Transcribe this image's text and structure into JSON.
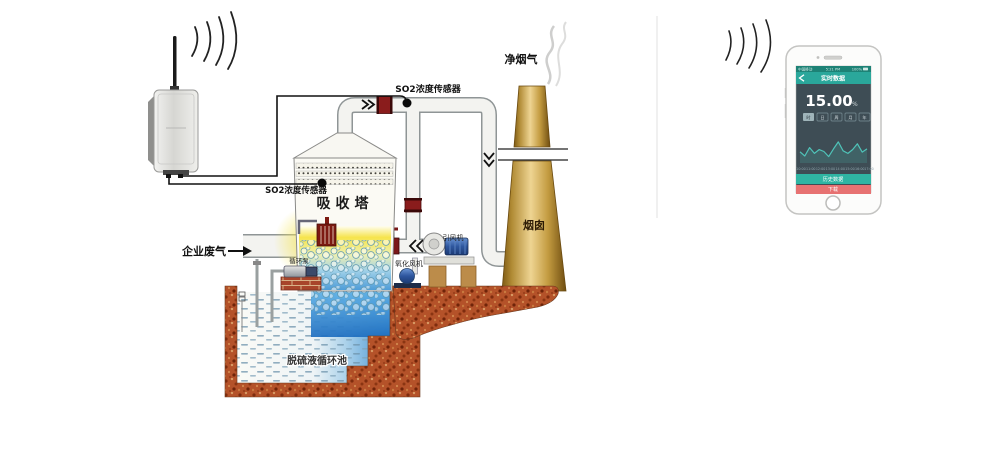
{
  "diagram": {
    "labels": {
      "so2_sensor_top": "SO2浓度传感器",
      "so2_sensor_left": "SO2浓度传感器",
      "absorber_tower": "吸收塔",
      "chimney": "烟囱",
      "clean_flue_gas": "净烟气",
      "enterprise_waste_gas": "企业废气",
      "desulfurization_pool": "脱硫液循环池",
      "induced_draft_fan": "引风机",
      "oxidation_fan": "氧化风机",
      "circulation_pump": "循环泵"
    },
    "colors": {
      "pipe_fill": "#f3f3f0",
      "earth": "#b45229",
      "chimney_gold": "#eed492",
      "tower_glow_yellow": "#f5e54e",
      "pool_blue": "#4190d0"
    }
  },
  "phone": {
    "status_bar": {
      "carrier": "中国移动",
      "time": "5:21 PM",
      "battery": "100%"
    },
    "nav": {
      "title": "实时数据"
    },
    "reading": {
      "value": "15.00",
      "unit": "%"
    },
    "ranges": [
      "时",
      "日",
      "周",
      "月",
      "年"
    ],
    "chart_data": {
      "type": "line",
      "x_labels": [
        "10:00",
        "11:00",
        "12:00",
        "13:00",
        "14:00",
        "15:00",
        "16:00",
        "17:00"
      ],
      "values": [
        35,
        22,
        48,
        30,
        42,
        36,
        20,
        44,
        66,
        38,
        30,
        42,
        60,
        34,
        44
      ],
      "line_color": "#4fc3b8",
      "ylabel": "",
      "legend": []
    },
    "buttons": {
      "primary": "历史数据",
      "danger": "下载"
    },
    "colors": {
      "header_teal": "#2aa79b",
      "status_teal": "#1d8276",
      "screen_dark": "#3e4d55",
      "primary_btn": "#2fb5a3",
      "danger_btn": "#e77272"
    }
  }
}
